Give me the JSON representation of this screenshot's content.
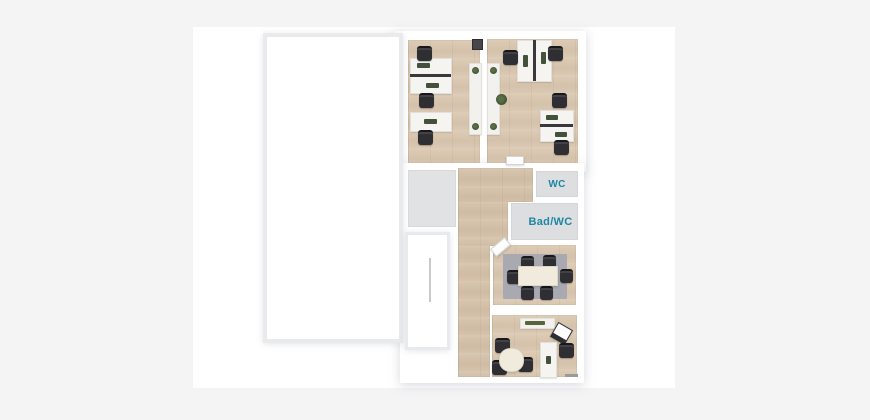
{
  "page": {
    "background_color": "#f4f4f5",
    "canvas_color": "#ffffff"
  },
  "floorplan": {
    "kind": "3d-office-floor-plan-top-view",
    "labels": {
      "wc": "WC",
      "bad_wc": "Bad/WC"
    },
    "colors": {
      "label_text": "#1d87a4",
      "wood_floor": "#dac8b2",
      "tile_floor": "#dcdee0",
      "storage_floor": "#e0e2e4",
      "meeting_rug": "#a9aab1",
      "chair": "#2e2e33",
      "desk": "#f5f4f0",
      "meeting_table": "#f0ebdd",
      "plant_green": "#4e5e3d",
      "wall_outline": "#e9eaec"
    },
    "rooms": [
      {
        "id": "large-unfurnished-room",
        "label": ""
      },
      {
        "id": "office-left",
        "furniture": [
          "double desk with 2 chairs",
          "single desk with chair",
          "sideboard",
          "equipment box"
        ]
      },
      {
        "id": "office-right",
        "furniture": [
          "double desk with 2 chairs",
          "double desk with 2 chairs",
          "sideboard",
          "plant"
        ]
      },
      {
        "id": "hallway",
        "furniture": []
      },
      {
        "id": "storage-room",
        "furniture": []
      },
      {
        "id": "entrance-room",
        "furniture": [
          "door line"
        ]
      },
      {
        "id": "wc",
        "label": "WC"
      },
      {
        "id": "bad-wc",
        "label": "Bad/WC"
      },
      {
        "id": "meeting-room",
        "furniture": [
          "rug",
          "conference table",
          "6 chairs",
          "open door leaf"
        ]
      },
      {
        "id": "office-bottom",
        "furniture": [
          "sideboard",
          "lounge chair",
          "desk with chair",
          "round table with 3 chairs"
        ]
      }
    ]
  }
}
